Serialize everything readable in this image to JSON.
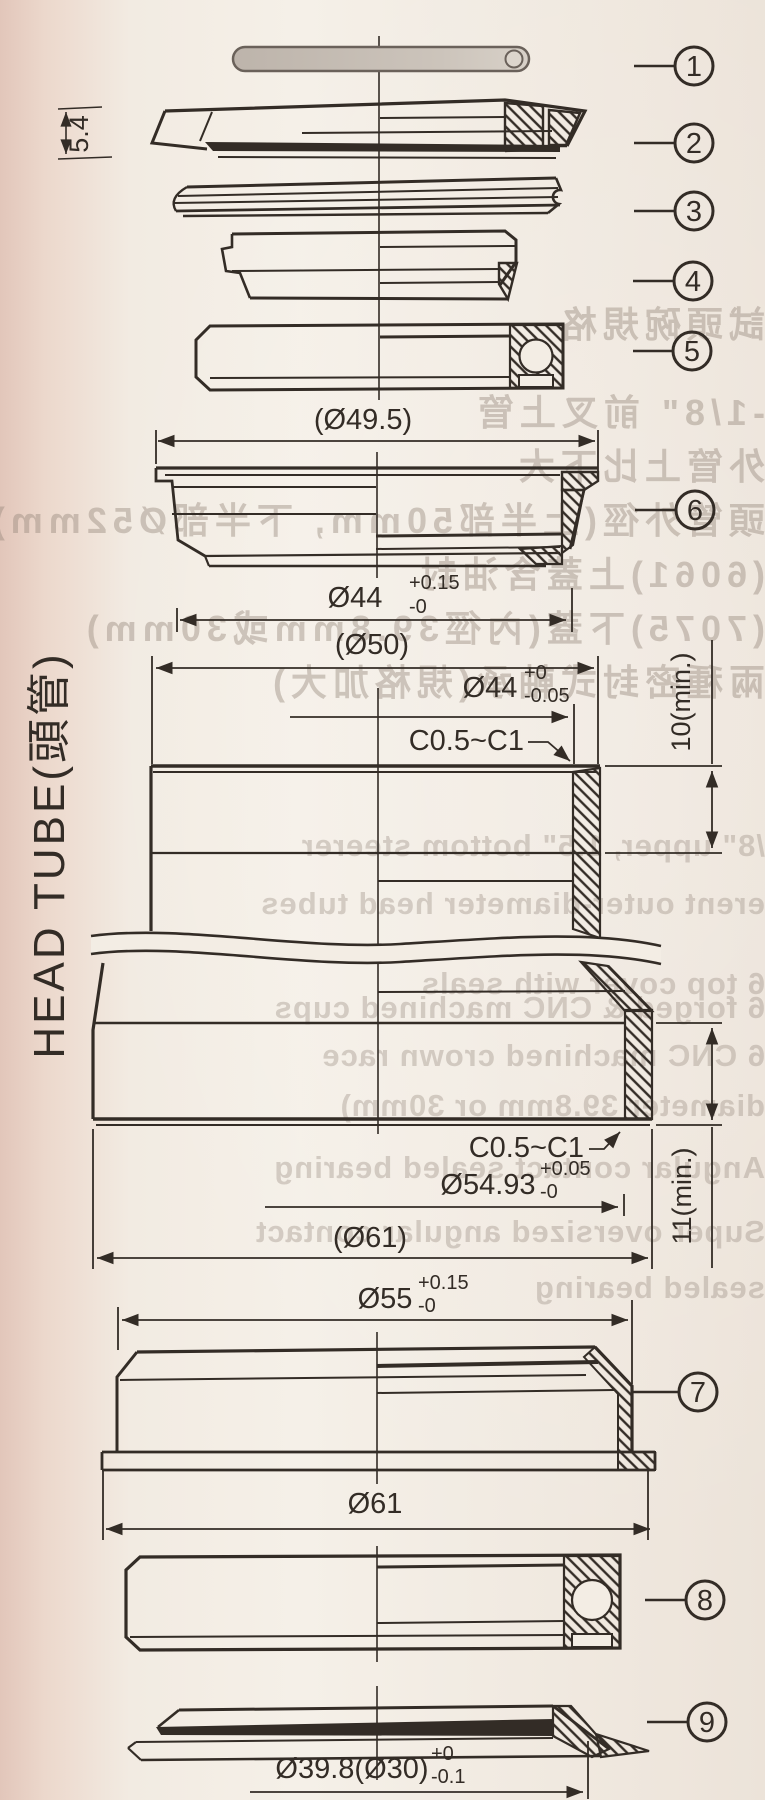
{
  "drawing": {
    "head_tube_label": "HEAD TUBE(頭管)",
    "balloons": [
      "1",
      "2",
      "3",
      "4",
      "5",
      "6",
      "7",
      "8",
      "9"
    ],
    "dims": {
      "cover_height": "5.4",
      "d49_5": "(Ø49.5)",
      "d44_cup": {
        "main": "Ø44",
        "sup": "+0.15",
        "sub": "-0"
      },
      "d50": "(Ø50)",
      "d44_ht": {
        "main": "Ø44",
        "sup": "+0",
        "sub": "-0.05"
      },
      "chamfer_top": "C0.5~C1",
      "depth_top": "10(min.)",
      "chamfer_bottom": "C0.5~C1",
      "d54_93": {
        "main": "Ø54.93",
        "sup": "+0.05",
        "sub": "-0"
      },
      "d61_ht": "(Ø61)",
      "depth_bottom": "11(min.)",
      "d55": {
        "main": "Ø55",
        "sup": "+0.15",
        "sub": "-0"
      },
      "d61_cup": "Ø61",
      "d39_8": {
        "main": "Ø39.8(Ø30)",
        "sup": "+0",
        "sub": "-0.1"
      }
    },
    "colors": {
      "line": "#332c26",
      "paper": "#f3ede4",
      "oring_fill": "#c3bbb2"
    }
  },
  "bleed": {
    "lines": [
      {
        "text": "試頭碗規格"
      },
      {
        "text": "-1/8\" 前叉上管"
      },
      {
        "text": "外管上比下大"
      },
      {
        "text": "頭管外徑(上半部50mm, 下半部Ø52mm)"
      },
      {
        "text": "(6061)上蓋含油封"
      },
      {
        "text": "(7075)下蓋(內徑39.8mm或30mm)"
      },
      {
        "text": "兩種密封式軸承(規格加大)"
      },
      {
        "text": "/8\" upper, 1.5\" bottom steerer"
      },
      {
        "text": "erent outer-diameter head tubes"
      },
      {
        "text": "6 top cover with seals"
      },
      {
        "text": "6 forged & CNC machined cups"
      },
      {
        "text": "6 CNC machined crown race"
      },
      {
        "text": "diameter 39.8mm or 30mm)"
      },
      {
        "text": "Angular contact sealed bearing"
      },
      {
        "text": "Super oversized angular contact"
      },
      {
        "text": "sealed bearing"
      }
    ]
  }
}
